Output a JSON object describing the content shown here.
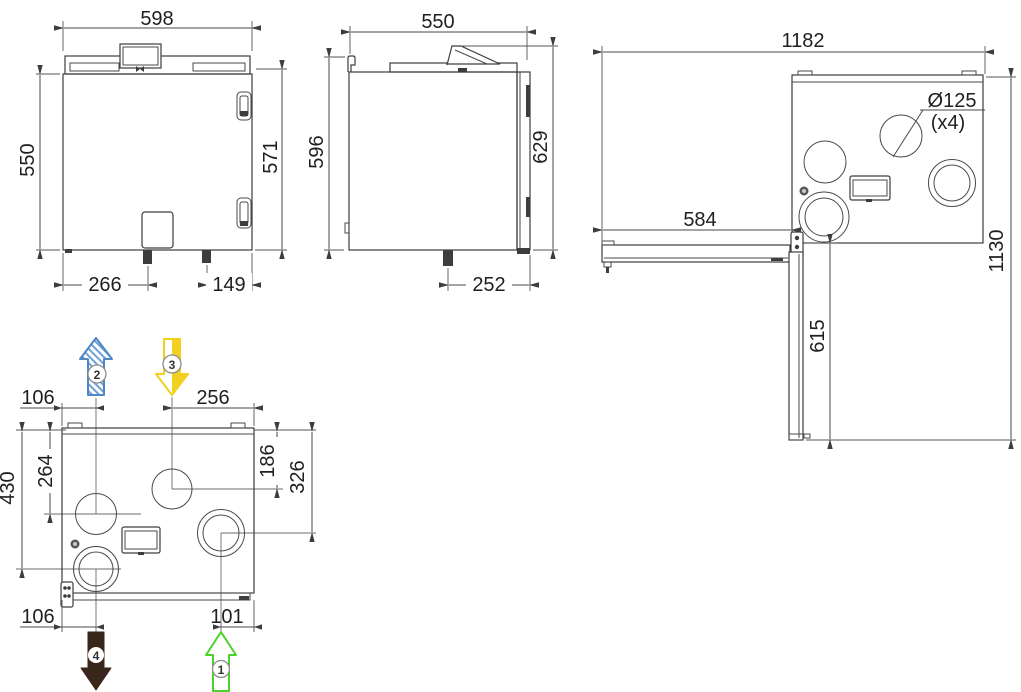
{
  "views": {
    "front": {
      "label": "front-view",
      "width": "598",
      "height_left": "550",
      "height_right": "571",
      "drain_offset_left": "266",
      "drain_offset_right": "149"
    },
    "side": {
      "label": "side-view",
      "depth": "550",
      "height_body": "596",
      "height_total": "629",
      "drain_offset": "252"
    },
    "top_door_open": {
      "label": "top-view-door-open",
      "width_total": "1182",
      "width_door": "584",
      "height_total": "1130",
      "door_length": "615",
      "duct_diameter": "Ø125",
      "duct_quantity": "(x4)"
    },
    "top_connections": {
      "label": "top-view-duct-connections",
      "port2_x": "106",
      "port3_x": "256",
      "port2_y": "264",
      "port4_y": "430",
      "port3_y": "186",
      "port1_y": "326",
      "port4_x": "106",
      "port1_x": "101"
    }
  },
  "airflow_arrows": [
    {
      "number": "1",
      "direction": "up",
      "style": "outline",
      "color": "#4cd22a"
    },
    {
      "number": "2",
      "direction": "up",
      "style": "hatched",
      "color": "#4f86c8"
    },
    {
      "number": "3",
      "direction": "down",
      "style": "half-filled",
      "color": "#f1d01f"
    },
    {
      "number": "4",
      "direction": "down",
      "style": "solid",
      "color": "#38261a"
    }
  ],
  "palette": {
    "line": "#3d3d3d",
    "dim_line": "#555555",
    "text": "#1f1f1f",
    "background": "#ffffff"
  }
}
